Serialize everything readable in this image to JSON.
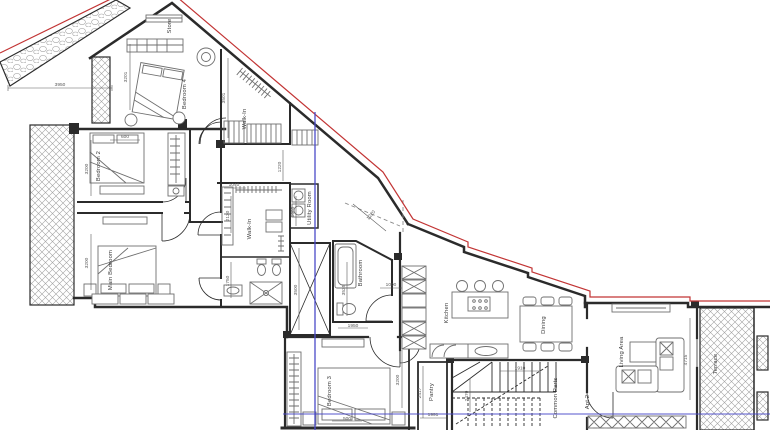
{
  "drawing": {
    "kind": "apartment-floor-plan",
    "rooms": {
      "store": "Store",
      "bedroom4": "Bedroom 4",
      "walkin_top": "Walk-In",
      "bedroom2": "Bedroom 2",
      "main_bedroom": "Main Bedroom",
      "walkin_mid": "Walk-In",
      "utility": "Utility Room",
      "bathroom": "Bathroom",
      "bedroom3": "Bedroom 3",
      "kitchen": "Kitchen",
      "dining": "Dining",
      "pantry": "Pantry",
      "common_parts": "Common Parts",
      "apt2": "Apt 2",
      "living": "Living Area",
      "terrace": "Terrace"
    },
    "dims": {
      "site_width": "3950",
      "bedroom4_left": "3201",
      "bedroom4_right": "3501",
      "bed4_width": "600",
      "walkin_gap": "1220",
      "corridor_top": "1040",
      "walkin_mid_height": "2130",
      "ensuite_height": "1750",
      "utility_height": "1685",
      "shaft_height": "3500",
      "bathroom_height": "3535",
      "bathroom_width": "1950",
      "hall_width": "1000",
      "diag_offset": "1220",
      "bedroom2_height": "3200",
      "main_bedroom_height": "3200",
      "bedroom3_height": "3200",
      "bed3_gap": "500",
      "pantry_height": "2417",
      "pantry_width": "1991",
      "stair_height": "2470",
      "stair_width": "1910",
      "living_height": "4715"
    },
    "colors": {
      "wall": "#2b2b2b",
      "furniture": "#6f6f6f",
      "hatch": "#a3a3a3",
      "boundary_red": "#c23434",
      "guide_blue": "#4a4ac8",
      "dim": "#5a5a5a",
      "label": "#3c3c3c"
    }
  }
}
